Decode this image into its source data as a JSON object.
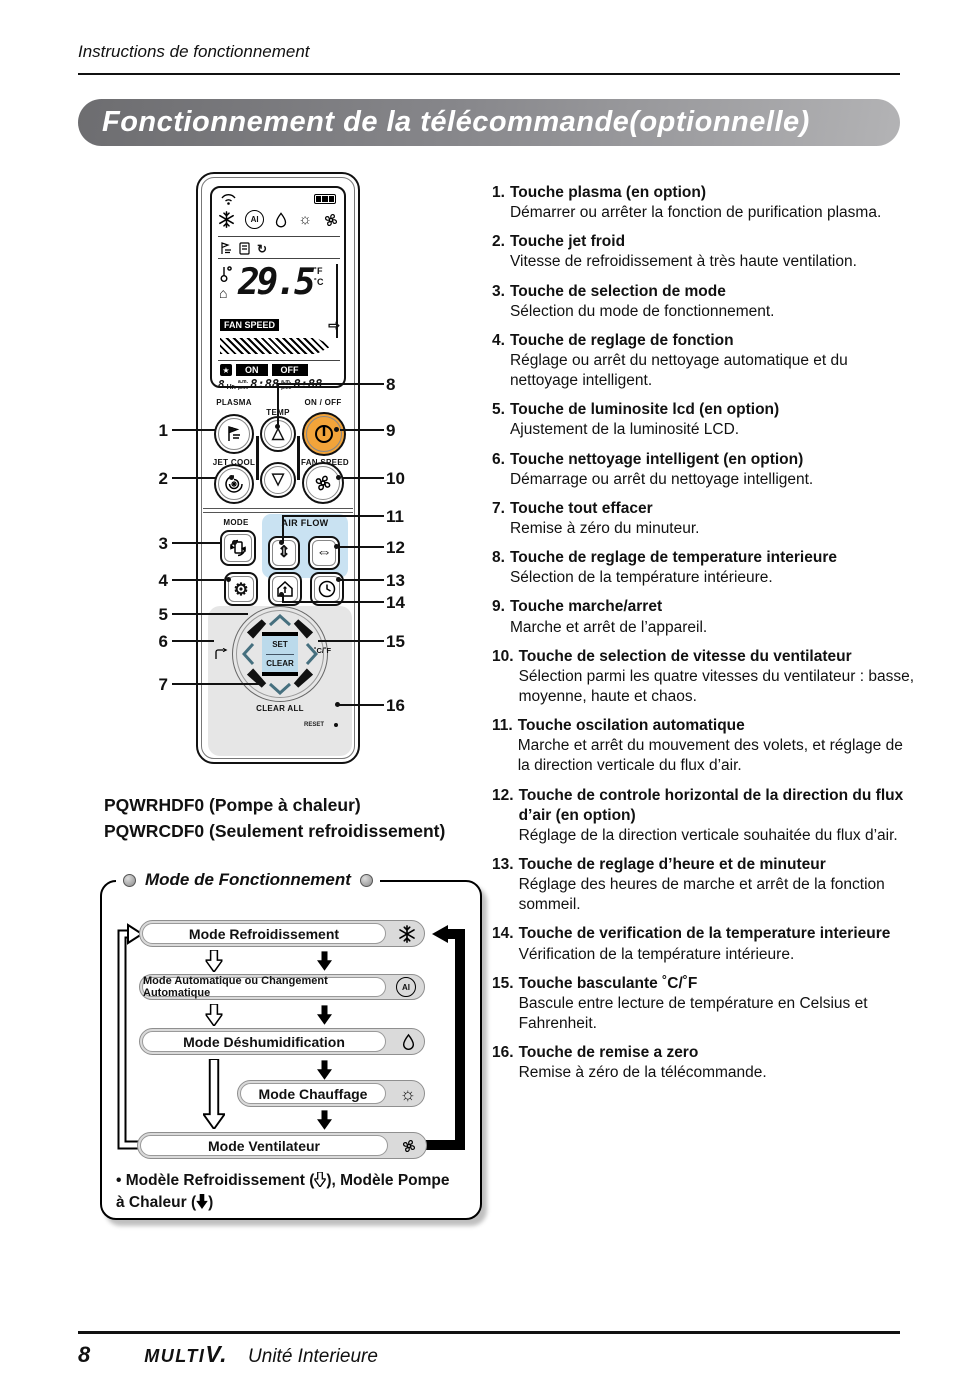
{
  "page": {
    "header": "Instructions de fonctionnement",
    "title": "Fonctionnement de la  télécommande(optionnelle)"
  },
  "items": [
    {
      "num": "1.",
      "title": "Touche plasma (en option)",
      "desc": "Démarrer ou arrêter la fonction de purification plasma."
    },
    {
      "num": "2.",
      "title": "Touche jet froid",
      "desc": "Vitesse de refroidissement à très haute ventilation."
    },
    {
      "num": "3.",
      "title": "Touche de selection de mode",
      "desc": "Sélection du mode de fonctionnement."
    },
    {
      "num": "4.",
      "title": "Touche de reglage de fonction",
      "desc": "Réglage ou arrêt du nettoyage automatique et du nettoyage intelligent."
    },
    {
      "num": "5.",
      "title": "Touche de luminosite lcd (en option)",
      "desc": "Ajustement de la luminosité LCD."
    },
    {
      "num": "6.",
      "title": "Touche nettoyage intelligent (en option)",
      "desc": "Démarrage ou arrêt du nettoyage intelligent."
    },
    {
      "num": "7.",
      "title": "Touche tout effacer",
      "desc": "Remise à zéro du minuteur."
    },
    {
      "num": "8.",
      "title": "Touche de reglage de temperature interieure",
      "desc": "Sélection de la température intérieure."
    },
    {
      "num": "9.",
      "title": "Touche marche/arret",
      "desc": "Marche et arrêt de l’appareil."
    },
    {
      "num": "10.",
      "title": "Touche de selection de vitesse du ventilateur",
      "desc": "Sélection parmi les quatre vitesses du ventilateur : basse, moyenne, haute et chaos."
    },
    {
      "num": "11.",
      "title": "Touche oscilation automatique",
      "desc": "Marche et arrêt du mouvement des volets, et réglage de la direction verticale du flux d’air."
    },
    {
      "num": "12.",
      "title": "Touche de controle horizontal de la direction du flux d’air (en option)",
      "desc": "Réglage de la direction verticale souhaitée du flux d’air."
    },
    {
      "num": "13.",
      "title": "Touche de reglage d’heure et de minuteur",
      "desc": "Réglage des heures de marche et arrêt de la fonction sommeil."
    },
    {
      "num": "14.",
      "title": "Touche de verification de la temperature interieure",
      "desc": "Vérification de la température intérieure."
    },
    {
      "num": "15.",
      "title": "Touche basculante ˚C/˚F",
      "desc": "Bascule entre lecture de température en Celsius et Fahrenheit."
    },
    {
      "num": "16.",
      "title": "Touche de remise a zero",
      "desc": "Remise à zéro de la télécommande."
    }
  ],
  "remote": {
    "labels": {
      "plasma": "PLASMA",
      "temp": "TEMP",
      "onoff": "ON / OFF",
      "jetcool": "JET COOL",
      "fanspeed": "FAN SPEED",
      "mode": "MODE",
      "airflow": "AIR FLOW",
      "time3sec": "TIME(3SEC)",
      "set": "SET",
      "clear": "CLEAR",
      "clearall": "CLEAR ALL",
      "reset": "RESET",
      "cf": "˚C/˚F"
    },
    "display": {
      "temperature": "29.5",
      "unit_f": "˚F",
      "unit_c": "˚C",
      "fanspeed_label": "FAN SPEED",
      "timer_on": "ON",
      "timer_off": "OFF",
      "hr_digit": "8",
      "hr_label": "Hr.",
      "am": "a.m.",
      "pm": "p.m.",
      "time1": "8:88",
      "time2": "8:88"
    },
    "callouts": [
      "1",
      "2",
      "3",
      "4",
      "5",
      "6",
      "7",
      "8",
      "9",
      "10",
      "11",
      "12",
      "13",
      "14",
      "15",
      "16"
    ]
  },
  "icons": {
    "gear": "⚙",
    "sun": "☼",
    "brightness": "☼",
    "updown": "⇕",
    "leftright": "⇔",
    "tri_up": "△",
    "tri_down": "▽",
    "arrow_right": "⇨",
    "house": "⌂",
    "cycle": "↻",
    "star": "★",
    "ai": "AI"
  },
  "models": {
    "line1": "PQWRHDF0 (Pompe à chaleur)",
    "line2": "PQWRCDF0 (Seulement refroidissement)"
  },
  "mode_box": {
    "title": "Mode de Fonctionnement",
    "modes": [
      {
        "label": "Mode Refroidissement",
        "icon": "snowflake-icon"
      },
      {
        "label": "Mode Automatique ou Changement Automatique",
        "icon": "ai-icon"
      },
      {
        "label": "Mode Déshumidification",
        "icon": "droplet-icon"
      },
      {
        "label": "Mode Chauffage",
        "icon": "sun-icon"
      },
      {
        "label": "Mode Ventilateur",
        "icon": "fan-icon"
      }
    ],
    "note": {
      "p1": "• Modèle Refroidissement (",
      "p2": "), Modèle Pompe",
      "p3": "à Chaleur (",
      "p4": ")"
    }
  },
  "footer": {
    "page_number": "8",
    "brand": "MULTI",
    "brand_v": "V.",
    "subtitle": "Unité Interieure"
  }
}
